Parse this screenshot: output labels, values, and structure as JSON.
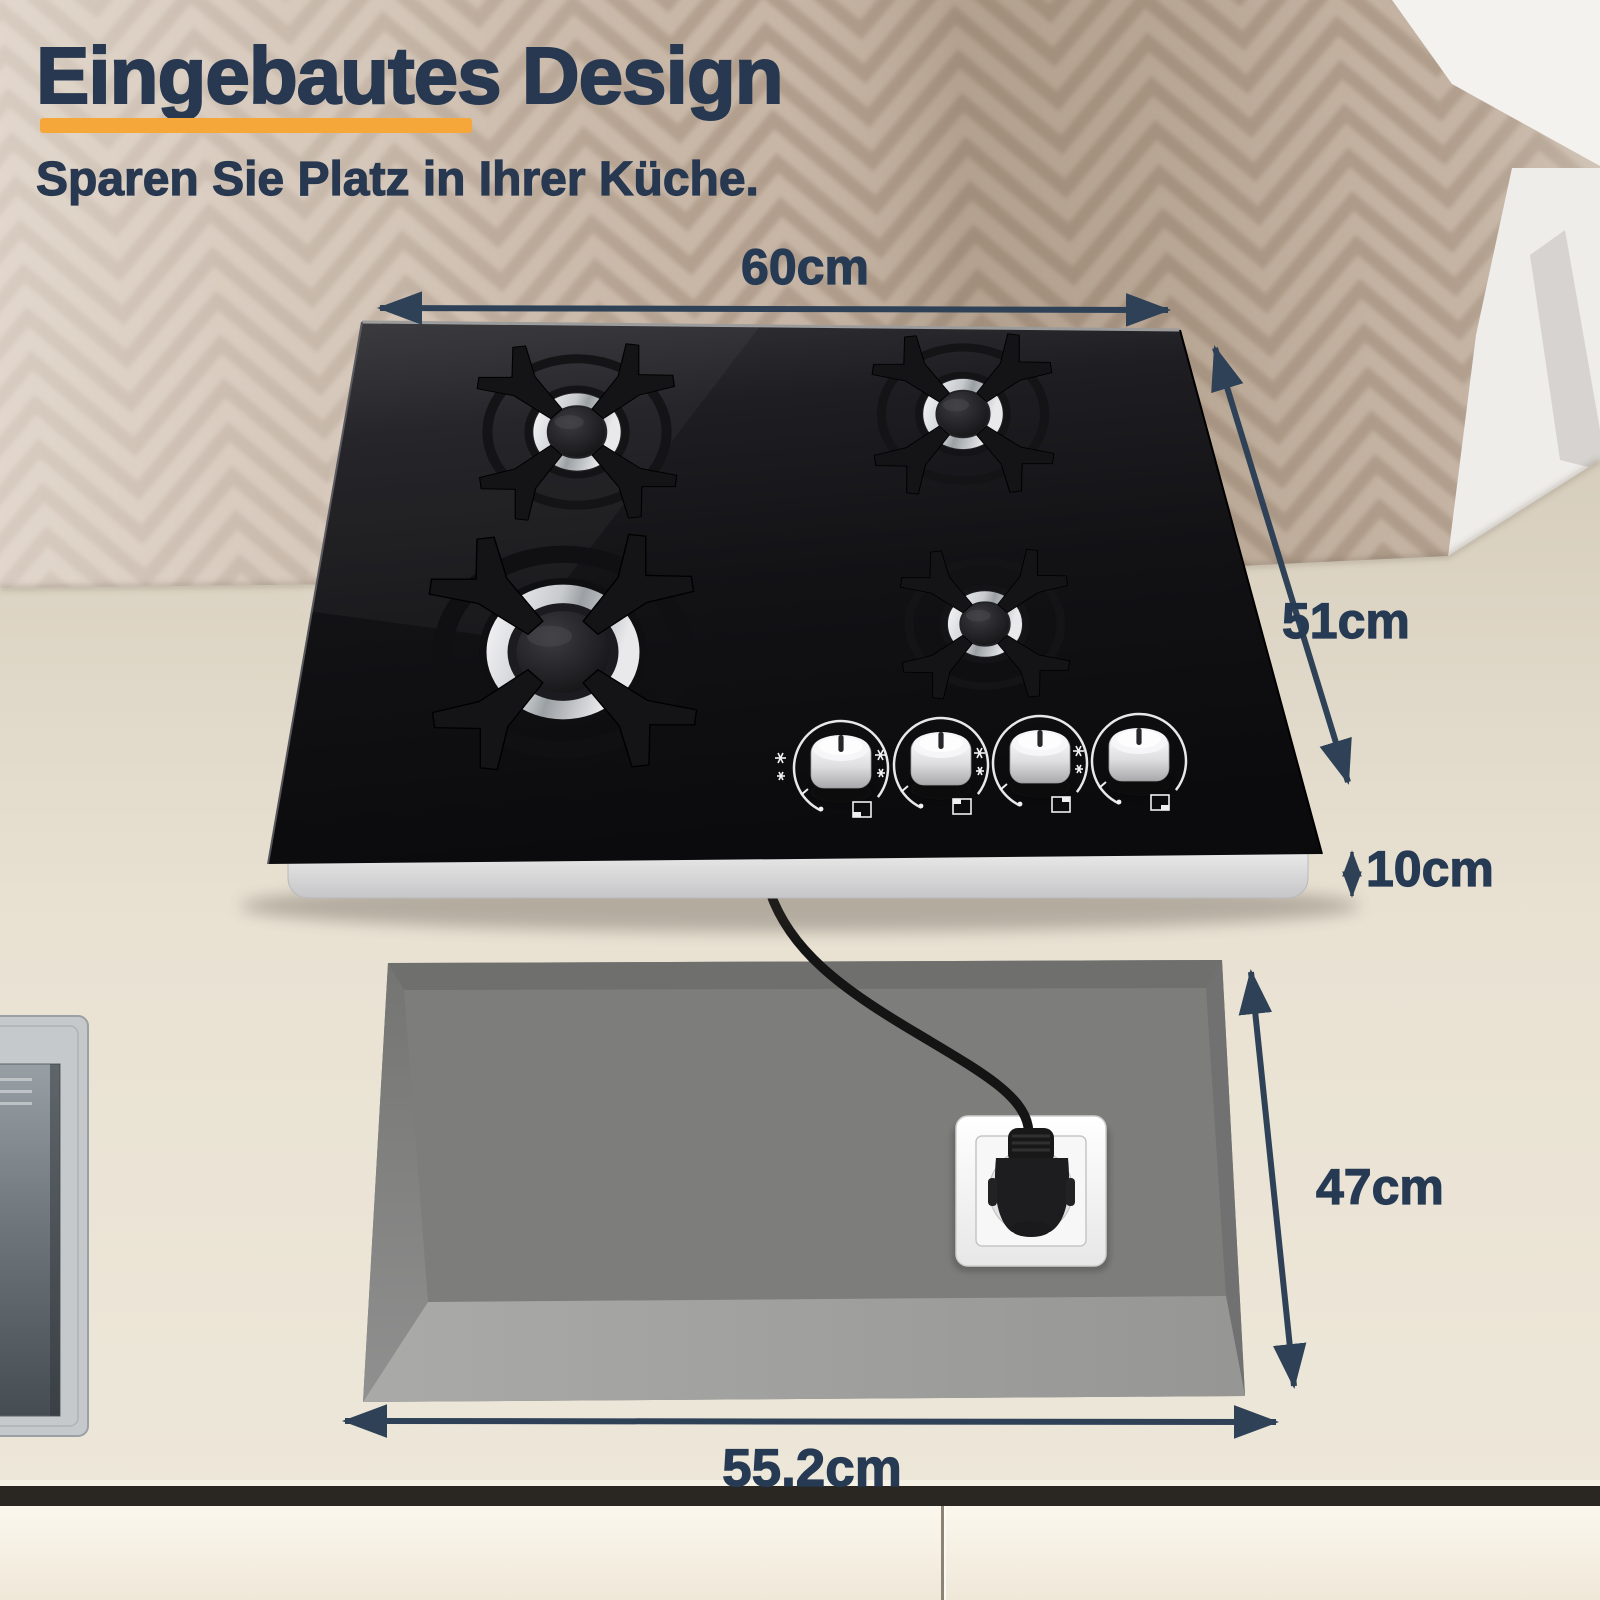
{
  "header": {
    "title": "Eingebautes Design",
    "subtitle": "Sparen Sie Platz in Ihrer Küche."
  },
  "dimensions": {
    "cooktop_width": "60cm",
    "cooktop_depth": "51cm",
    "cooktop_height": "10cm",
    "cutout_depth": "47cm",
    "cutout_width": "55.2cm"
  },
  "cooktop": {
    "burner_count": 4,
    "knob_count": 4,
    "knob_color": "white",
    "glass_color": "black"
  },
  "icons": {
    "dimension_arrow": "double-headed-arrow",
    "knob_side": "flame-symbols",
    "knob_bottom": "burner-position-square",
    "plug": "schuko-plug",
    "socket": "wall-socket"
  },
  "colors": {
    "accent_bar": "#F6A73A",
    "heading_text": "#273850",
    "dimension_text": "#263A54",
    "arrow": "#2E4156",
    "glass": "#121214",
    "cutout_gray": "#7D7D7B",
    "counter_beige": "#E7E0D1"
  }
}
